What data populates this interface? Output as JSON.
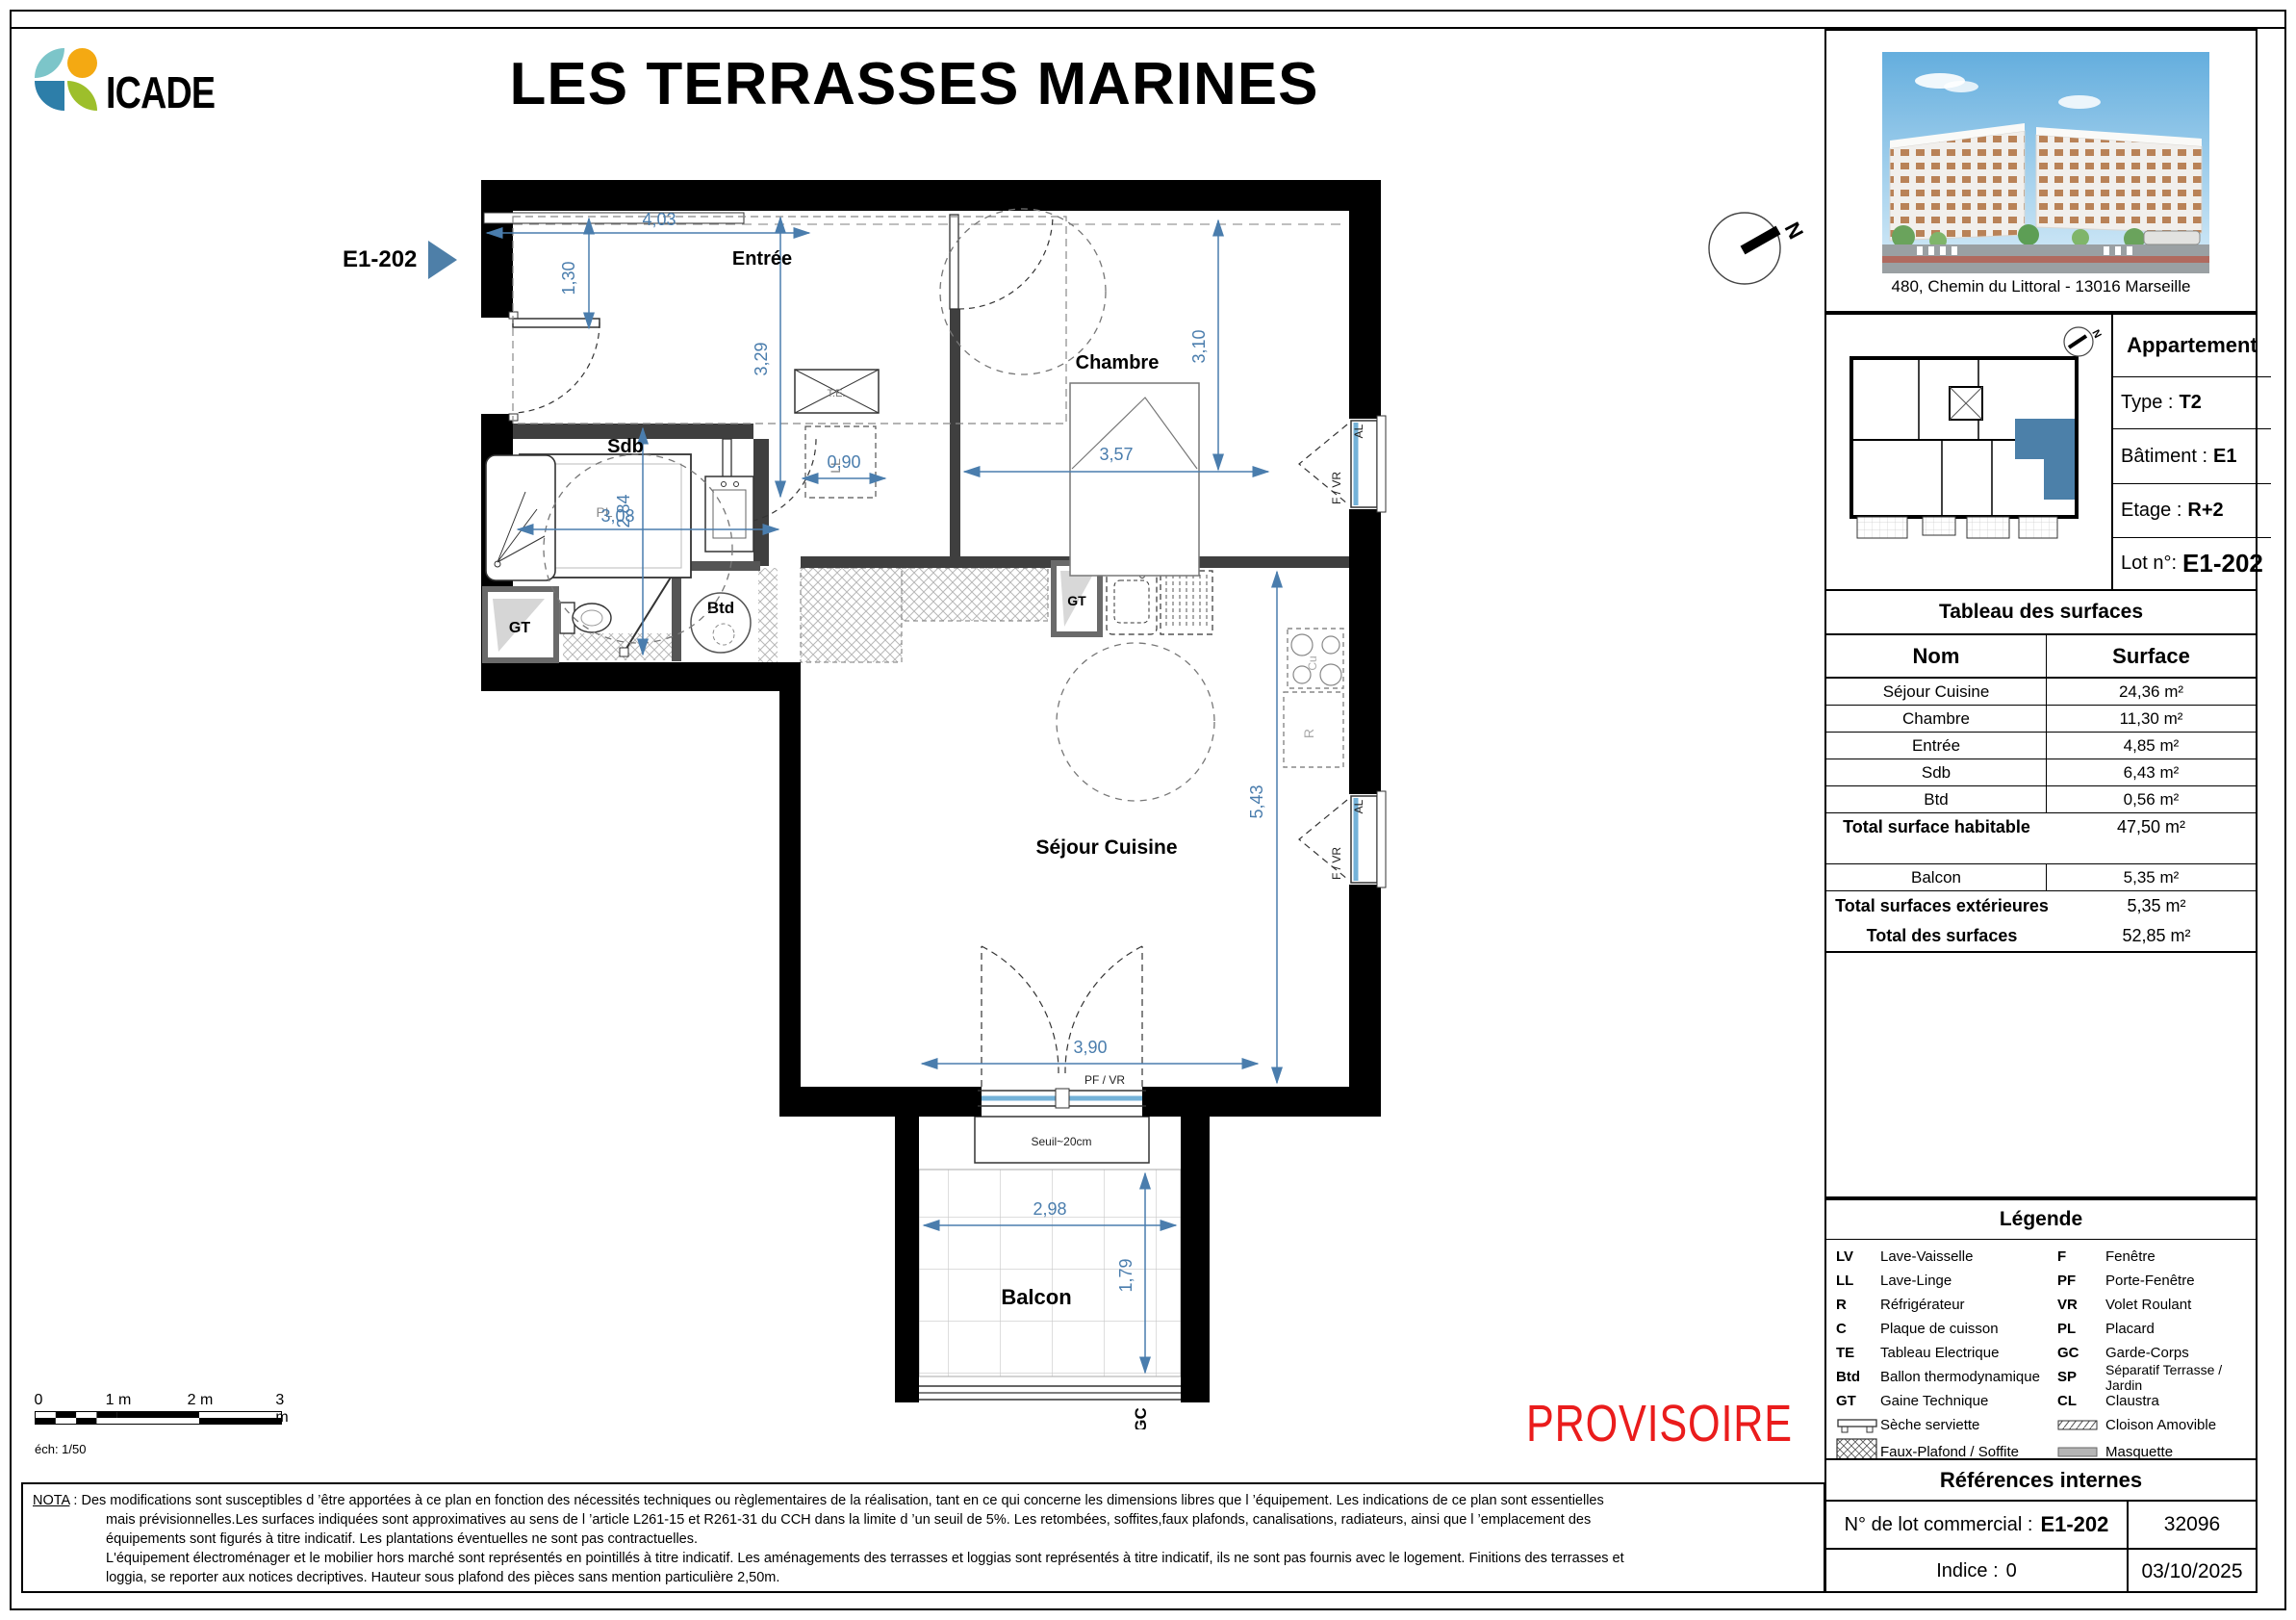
{
  "header": {
    "logo": "ICADE",
    "title": "LES TERRASSES MARINES"
  },
  "photo": {
    "address": "480, Chemin du Littoral - 13016 Marseille"
  },
  "apartment": {
    "title": "Appartement",
    "type_label": "Type :",
    "type": "T2",
    "batiment_label": "Bâtiment :",
    "batiment": "E1",
    "etage_label": "Etage :",
    "etage": "R+2",
    "lot_label": "Lot n°:",
    "lot": "E1-202"
  },
  "surfaces": {
    "title": "Tableau des surfaces",
    "col_nom": "Nom",
    "col_surface": "Surface",
    "rows": [
      {
        "nom": "Séjour Cuisine",
        "val": "24,36 m²"
      },
      {
        "nom": "Chambre",
        "val": "11,30 m²"
      },
      {
        "nom": "Entrée",
        "val": "4,85 m²"
      },
      {
        "nom": "Sdb",
        "val": "6,43 m²"
      },
      {
        "nom": "Btd",
        "val": "0,56 m²"
      }
    ],
    "total_hab_label": "Total surface habitable",
    "total_hab": "47,50 m²",
    "balcon_label": "Balcon",
    "balcon": "5,35 m²",
    "total_ext_label": "Total surfaces extérieures",
    "total_ext": "5,35 m²",
    "total_label": "Total des surfaces",
    "total": "52,85 m²"
  },
  "legend": {
    "title": "Légende",
    "left": [
      {
        "abbr": "LV",
        "label": "Lave-Vaisselle"
      },
      {
        "abbr": "LL",
        "label": "Lave-Linge"
      },
      {
        "abbr": "R",
        "label": "Réfrigérateur"
      },
      {
        "abbr": "C",
        "label": "Plaque de cuisson"
      },
      {
        "abbr": "TE",
        "label": "Tableau Electrique"
      },
      {
        "abbr": "Btd",
        "label": "Ballon thermodynamique"
      },
      {
        "abbr": "GT",
        "label": "Gaine Technique"
      },
      {
        "abbr": "",
        "label": "Sèche serviette"
      },
      {
        "abbr": "",
        "label": "Faux-Plafond / Soffite"
      }
    ],
    "right": [
      {
        "abbr": "F",
        "label": "Fenêtre"
      },
      {
        "abbr": "PF",
        "label": "Porte-Fenêtre"
      },
      {
        "abbr": "VR",
        "label": "Volet Roulant"
      },
      {
        "abbr": "PL",
        "label": "Placard"
      },
      {
        "abbr": "GC",
        "label": "Garde-Corps"
      },
      {
        "abbr": "SP",
        "label": "Séparatif Terrasse / Jardin"
      },
      {
        "abbr": "CL",
        "label": "Claustra"
      },
      {
        "abbr": "",
        "label": "Cloison Amovible"
      },
      {
        "abbr": "",
        "label": "Masquette"
      }
    ]
  },
  "references": {
    "title": "Références internes",
    "lot_label": "N° de l",
    "lot_label_full": "N° de lot commercial :",
    "lot": "E1-202",
    "code": "32096",
    "indice_label": "Indice :",
    "indice": "0",
    "date": "03/10/2025"
  },
  "plan": {
    "tag": "E1-202",
    "rooms": {
      "entree": "Entrée",
      "sdb": "Sdb",
      "btd": "Btd",
      "chambre": "Chambre",
      "sejour": "Séjour Cuisine",
      "balcon": "Balcon"
    },
    "dims": {
      "entree_w": "4,03",
      "entree_d": "1,30",
      "left_h": "3,29",
      "pass": "0,90",
      "chambre_w": "3,57",
      "chambre_h": "3,10",
      "sdb_w": "3,08",
      "sdb_h": "2,84",
      "sejour_h": "5,43",
      "sejour_w": "3,90",
      "balcon_w": "2,98",
      "balcon_d": "1,79"
    },
    "labels": {
      "pl": "PL",
      "te": "T.E.",
      "ll": "LL",
      "gt": "GT",
      "cu": "Cu",
      "r": "R",
      "f_vr": "F / VR",
      "al": "AL",
      "pf_vr": "PF / VR",
      "seuil": "Seuil~20cm",
      "gc": "GC",
      "north": "N"
    }
  },
  "scalebar": {
    "t0": "0",
    "t1": "1 m",
    "t2": "2 m",
    "t3": "3 m",
    "caption": "éch: 1/50"
  },
  "stamp": "PROVISOIRE",
  "nota": {
    "label": "NOTA",
    "lines": [
      " : Des modifications sont susceptibles d ’être apportées à ce plan en fonction des nécessités techniques ou règlementaires de la réalisation, tant en ce qui concerne les dimensions libres que l ’équipement. Les indications de ce plan sont essentielles",
      "mais prévisionnelles.Les surfaces indiquées sont approximatives au sens de l ’article L261-15 et R261-31 du CCH dans la limite d ’un seuil de 5%. Les retombées, soffites,faux plafonds, canalisations, radiateurs, ainsi que l ’emplacement des",
      "équipements sont figurés à titre indicatif. Les plantations éventuelles ne sont pas contractuelles.",
      "L'équipement électroménager et le mobilier hors marché sont représentés en pointillés à titre indicatif. Les aménagements des terrasses et loggias sont représentés à titre indicatif, ils ne sont pas fournis avec le logement. Finitions des terrasses et",
      "loggia, se reporter aux notices decriptives. Hauteur sous plafond des pièces sans mention particulière 2,50m."
    ]
  }
}
